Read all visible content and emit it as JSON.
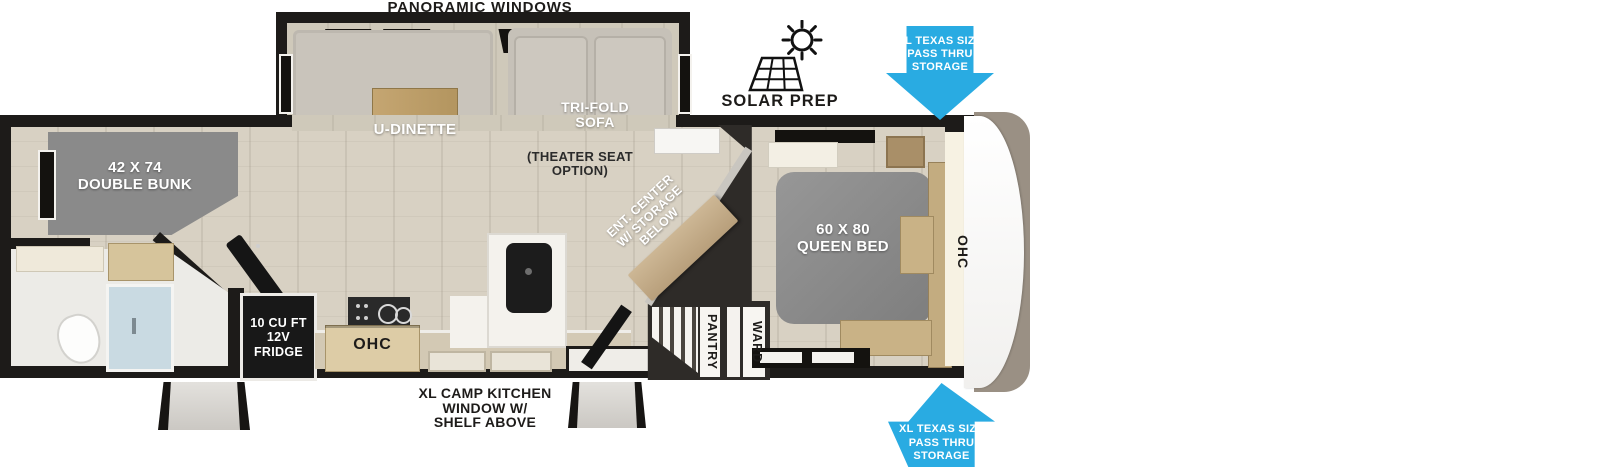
{
  "title": "Travel trailer floor plan",
  "labels": {
    "panoramic_windows": "PANORAMIC WINDOWS",
    "solar_prep": "SOLAR PREP",
    "pass_thru_top": "XL TEXAS SIZE\nPASS THRU\nSTORAGE",
    "pass_thru_bottom": "XL TEXAS SIZE\nPASS THRU\nSTORAGE",
    "u_dinette": "U-DINETTE",
    "tri_fold_sofa": "TRI-FOLD\nSOFA",
    "theater_seat_option": "(THEATER SEAT\nOPTION)",
    "double_bunk": "42 X 74\nDOUBLE BUNK",
    "ent_center": "ENT. CENTER\nW/ STORAGE\nBELOW",
    "queen_bed": "60 X 80\nQUEEN BED",
    "ohc_bedroom": "OHC",
    "fridge": "10 CU FT\n12V\nFRIDGE",
    "ohc_kitchen": "OHC",
    "pantry": "PANTRY",
    "ward": "WARD",
    "camp_kitchen": "XL CAMP KITCHEN\nWINDOW W/\nSHELF ABOVE"
  },
  "icons": {
    "solar_prep": "solar-panel-sun-icon",
    "pass_thru_top": "block-arrow-down-icon",
    "pass_thru_bottom": "block-arrow-up-icon"
  },
  "colors": {
    "arrow_blue": "#29abe2",
    "wall_black": "#1d1b19",
    "floor_beige": "#d8d1c3",
    "furniture_gray": "#8a8a8a",
    "wood_tan": "#c9b185",
    "charcoal": "#2e2b28",
    "shower_glass": "#c9dae2"
  }
}
